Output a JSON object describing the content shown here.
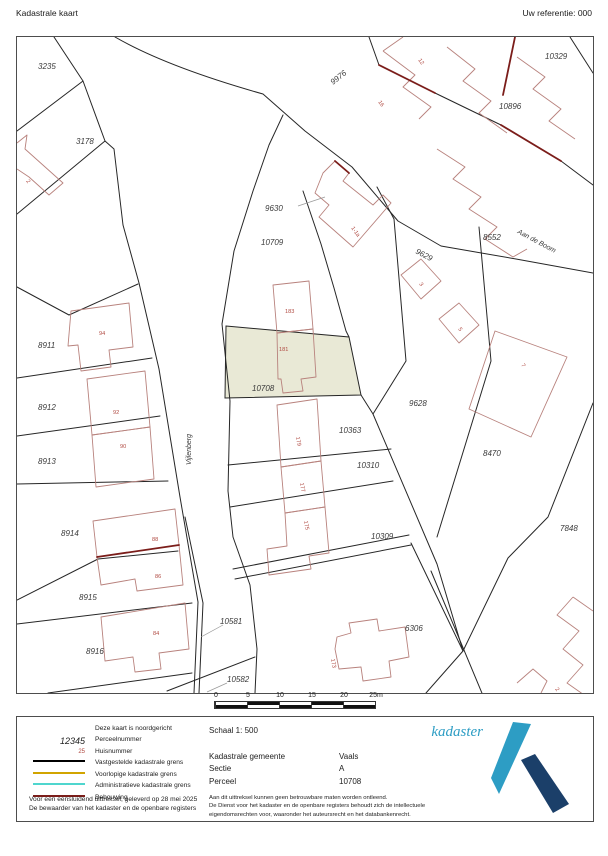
{
  "header": {
    "title": "Kadastrale kaart",
    "reference": "Uw referentie: 000"
  },
  "map": {
    "highlight_color": "#e9e9d6",
    "parcel_labels": [
      {
        "text": "3235",
        "x": 21,
        "y": 32,
        "rot": 0
      },
      {
        "text": "3178",
        "x": 59,
        "y": 107,
        "rot": 0
      },
      {
        "text": "9976",
        "x": 316,
        "y": 48,
        "rot": -38
      },
      {
        "text": "10329",
        "x": 528,
        "y": 22,
        "rot": 0
      },
      {
        "text": "10896",
        "x": 482,
        "y": 72,
        "rot": 0
      },
      {
        "text": "8552",
        "x": 466,
        "y": 203,
        "rot": 0
      },
      {
        "text": "9630",
        "x": 248,
        "y": 174,
        "rot": 0
      },
      {
        "text": "10709",
        "x": 244,
        "y": 208,
        "rot": 0
      },
      {
        "text": "9629",
        "x": 398,
        "y": 216,
        "rot": 28
      },
      {
        "text": "9628",
        "x": 392,
        "y": 369,
        "rot": 0
      },
      {
        "text": "8470",
        "x": 466,
        "y": 419,
        "rot": 0
      },
      {
        "text": "7848",
        "x": 543,
        "y": 494,
        "rot": 0
      },
      {
        "text": "10708",
        "x": 235,
        "y": 354,
        "rot": 0
      },
      {
        "text": "8911",
        "x": 21,
        "y": 311,
        "rot": 0
      },
      {
        "text": "8912",
        "x": 21,
        "y": 373,
        "rot": 0
      },
      {
        "text": "8913",
        "x": 21,
        "y": 427,
        "rot": 0
      },
      {
        "text": "8914",
        "x": 44,
        "y": 499,
        "rot": 0
      },
      {
        "text": "8915",
        "x": 62,
        "y": 563,
        "rot": 0
      },
      {
        "text": "8916",
        "x": 69,
        "y": 617,
        "rot": 0
      },
      {
        "text": "10581",
        "x": 203,
        "y": 587,
        "rot": 0
      },
      {
        "text": "10582",
        "x": 210,
        "y": 645,
        "rot": 0
      },
      {
        "text": "10363",
        "x": 322,
        "y": 396,
        "rot": 0
      },
      {
        "text": "10310",
        "x": 340,
        "y": 431,
        "rot": 0
      },
      {
        "text": "10309",
        "x": 354,
        "y": 502,
        "rot": 0
      },
      {
        "text": "6306",
        "x": 388,
        "y": 594,
        "rot": 0
      }
    ],
    "house_numbers": [
      {
        "text": "12",
        "x": 401,
        "y": 23,
        "rot": 55
      },
      {
        "text": "16",
        "x": 361,
        "y": 65,
        "rot": 55
      },
      {
        "text": "1-1a",
        "x": 334,
        "y": 191,
        "rot": 55
      },
      {
        "text": "3",
        "x": 402,
        "y": 247,
        "rot": 55
      },
      {
        "text": "5",
        "x": 441,
        "y": 292,
        "rot": 55
      },
      {
        "text": "7",
        "x": 504,
        "y": 328,
        "rot": 55
      },
      {
        "text": "183",
        "x": 268,
        "y": 276,
        "rot": 0
      },
      {
        "text": "181",
        "x": 262,
        "y": 314,
        "rot": 0
      },
      {
        "text": "179",
        "x": 279,
        "y": 400,
        "rot": 80
      },
      {
        "text": "177",
        "x": 283,
        "y": 446,
        "rot": 80
      },
      {
        "text": "175",
        "x": 287,
        "y": 484,
        "rot": 80
      },
      {
        "text": "173",
        "x": 314,
        "y": 622,
        "rot": 80
      },
      {
        "text": "94",
        "x": 82,
        "y": 298,
        "rot": 0
      },
      {
        "text": "92",
        "x": 96,
        "y": 377,
        "rot": 0
      },
      {
        "text": "90",
        "x": 103,
        "y": 411,
        "rot": 0
      },
      {
        "text": "88",
        "x": 135,
        "y": 504,
        "rot": 0
      },
      {
        "text": "86",
        "x": 138,
        "y": 541,
        "rot": 0
      },
      {
        "text": "84",
        "x": 136,
        "y": 598,
        "rot": 0
      },
      {
        "text": "2",
        "x": 9,
        "y": 144,
        "rot": 55
      },
      {
        "text": "2",
        "x": 538,
        "y": 652,
        "rot": 55
      }
    ],
    "street_labels": [
      {
        "text": "Vijlenberg",
        "x": 174,
        "y": 428,
        "rot": -90
      },
      {
        "text": "Aan de Boom",
        "x": 500,
        "y": 196,
        "rot": 28
      }
    ]
  },
  "scalebar": {
    "ticks": [
      "0",
      "5",
      "10",
      "15",
      "20",
      "25m"
    ]
  },
  "panel": {
    "north_note": "Deze kaart is noordgericht",
    "legend": [
      {
        "type": "perceel",
        "sample": "12345",
        "label": "Perceelnummer"
      },
      {
        "type": "huis",
        "sample": "25",
        "label": "Huisnummer"
      },
      {
        "type": "line",
        "color": "#000000",
        "label": "Vastgestelde kadastrale grens"
      },
      {
        "type": "line",
        "color": "#d1a400",
        "label": "Voorlopige kadastrale grens"
      },
      {
        "type": "line",
        "color": "#4fd6ce",
        "label": "Administratieve kadastrale grens"
      },
      {
        "type": "line",
        "color": "#7b1d1a",
        "label": "Bebouwing"
      }
    ],
    "footer_left": [
      "Voor een eensluidend uittreksel, geleverd op 28 mei 2025",
      "De bewaarder van het kadaster en de openbare registers"
    ],
    "scale": "Schaal 1: 500",
    "details": [
      {
        "label": "Kadastrale gemeente",
        "value": "Vaals"
      },
      {
        "label": "Sectie",
        "value": "A"
      },
      {
        "label": "Perceel",
        "value": "10708"
      }
    ],
    "disclaimer": [
      "Aan dit uittreksel kunnen geen betrouwbare maten worden ontleend.",
      "De Dienst voor het kadaster en de openbare registers behoudt zich de intellectuele",
      "eigendomsrechten voor, waaronder het auteursrecht en het databankenrecht."
    ],
    "logo_text": "kadaster",
    "logo_colors": {
      "teal": "#2d9dc4",
      "navy": "#1b3f69"
    }
  }
}
